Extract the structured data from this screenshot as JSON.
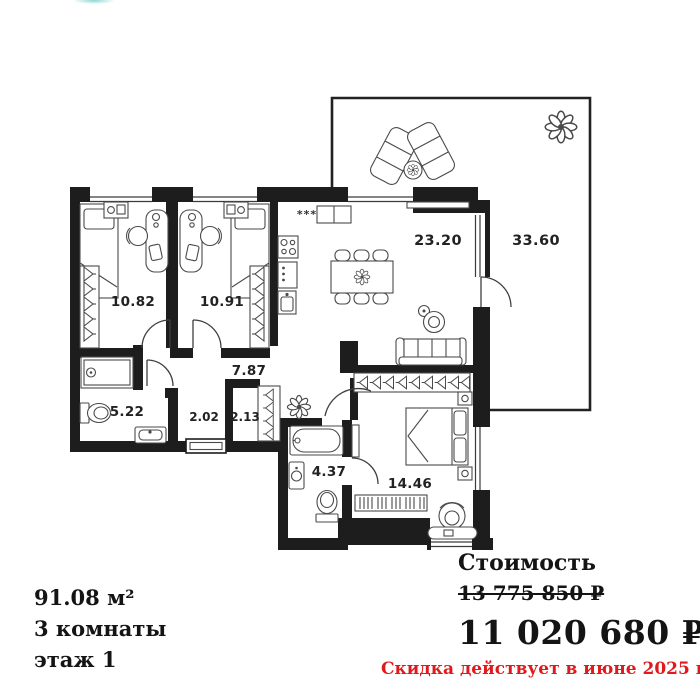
{
  "floor_plan": {
    "labels": {
      "bedroom1": "10.82",
      "bedroom2": "10.91",
      "living": "23.20",
      "terrace": "33.60",
      "hall": "7.87",
      "bathroom1": "5.22",
      "closet": "2.02",
      "wardrobe": "2.13",
      "bathroom2": "4.37",
      "bedroom3": "14.46"
    },
    "vent_symbol": "***"
  },
  "apartment": {
    "area": "91.08 м²",
    "rooms": "3 комнаты",
    "floor": "этаж 1"
  },
  "pricing": {
    "label": "Стоимость",
    "old_price": "13 775 850 ₽",
    "price": "11 020 680 ₽",
    "discount_note": "Скидка действует в июне 2025 г."
  },
  "colors": {
    "wall": "#1d1d1d",
    "furniture_line": "#4a4a4a",
    "text": "#141414",
    "discount_red": "#e0191c",
    "logo_teal": "#8fd8d5"
  }
}
